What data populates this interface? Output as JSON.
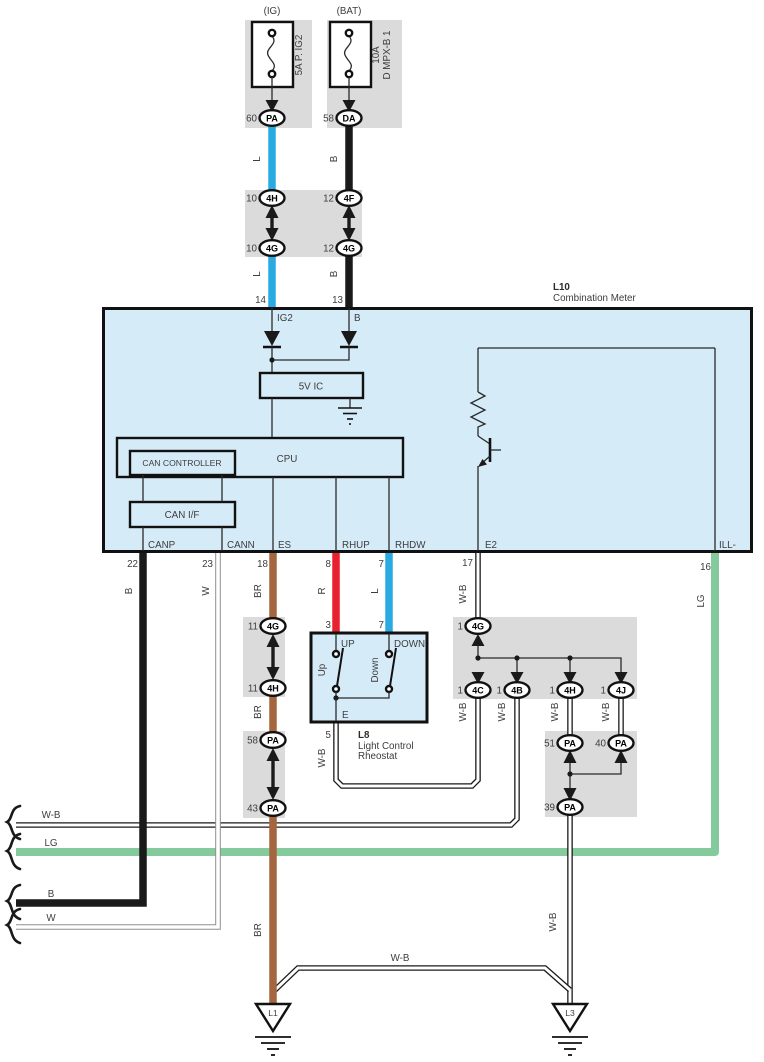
{
  "colors": {
    "wire_blue": "#29ABE2",
    "wire_black": "#1A1A1A",
    "wire_red": "#E8212E",
    "wire_brown": "#A5653E",
    "wire_light_green": "#85CA9D",
    "component_fill": "#D6EBF8",
    "connector_shade": "#DBDBDB"
  },
  "wires": {
    "l": "L",
    "b": "B",
    "w": "W",
    "br": "BR",
    "r": "R",
    "wb": "W-B",
    "lg": "LG"
  },
  "fuse_ig": {
    "source": "(IG)",
    "label": "5A P. IG2",
    "pin": "60",
    "connector": "PA"
  },
  "fuse_bat": {
    "source": "(BAT)",
    "rating": "10A",
    "label": "D MPX-B 1",
    "pin": "58",
    "connector": "DA"
  },
  "junction_block": {
    "tl_pin": "10",
    "tl_code": "4H",
    "tr_pin": "12",
    "tr_code": "4F",
    "bl_pin": "10",
    "bl_code": "4G",
    "br_pin": "12",
    "br_code": "4G"
  },
  "meter": {
    "code": "L10",
    "name": "Combination Meter",
    "top_pins": {
      "ig2_num": "14",
      "ig2": "IG2",
      "b_num": "13",
      "b": "B"
    },
    "blocks": {
      "ic": "5V IC",
      "cpu": "CPU",
      "can_controller": "CAN CONTROLLER",
      "can_if": "CAN I/F"
    },
    "bottom_pins": {
      "canp": {
        "num": "22",
        "name": "CANP"
      },
      "cann": {
        "num": "23",
        "name": "CANN"
      },
      "es": {
        "num": "18",
        "name": "ES"
      },
      "rhup": {
        "num": "8",
        "name": "RHUP"
      },
      "rhdw": {
        "num": "7",
        "name": "RHDW"
      },
      "e2": {
        "num": "17",
        "name": "E2"
      },
      "ill": {
        "num": "16",
        "name": "ILL-"
      }
    }
  },
  "rheostat": {
    "code": "L8",
    "name_line1": "Light Control",
    "name_line2": "Rheostat",
    "pin_up": "3",
    "pin_down": "7",
    "pin_e": "5",
    "label_up": "UP",
    "label_down": "DOWN",
    "switch_up": "Up",
    "switch_down": "Down",
    "terminal_e": "E"
  },
  "es_connectors": [
    {
      "pin": "11",
      "code": "4G"
    },
    {
      "pin": "11",
      "code": "4H"
    },
    {
      "pin": "58",
      "code": "PA"
    },
    {
      "pin": "43",
      "code": "PA"
    }
  ],
  "e2_connectors": [
    {
      "pin": "1",
      "code": "4G"
    },
    {
      "pin": "1",
      "code": "4C"
    },
    {
      "pin": "1",
      "code": "4B"
    },
    {
      "pin": "1",
      "code": "4H"
    },
    {
      "pin": "1",
      "code": "4J"
    }
  ],
  "pa_connectors": [
    {
      "pin": "51",
      "code": "PA"
    },
    {
      "pin": "40",
      "code": "PA"
    },
    {
      "pin": "39",
      "code": "PA"
    }
  ],
  "left_exits": [
    {
      "label": "W-B"
    },
    {
      "label": "LG"
    },
    {
      "label": "B"
    },
    {
      "label": "W"
    }
  ],
  "grounds": {
    "left": "L1",
    "right": "L3"
  }
}
